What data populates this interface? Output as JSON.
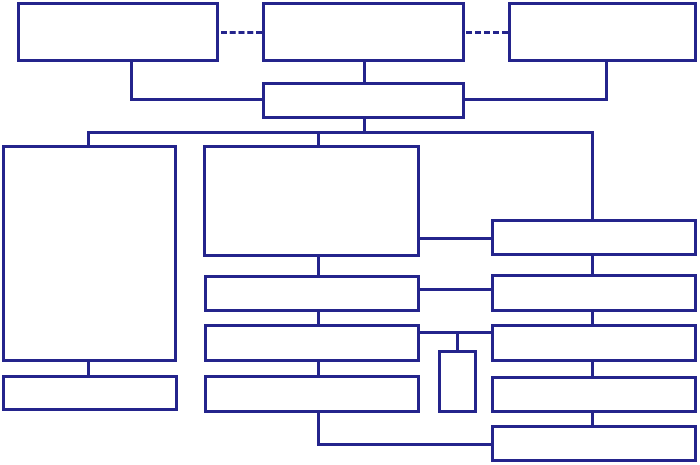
{
  "diagram": {
    "type": "flowchart",
    "background_color": "#ffffff",
    "line_color": "#24248C",
    "box_fill_color": "#ffffff",
    "line_width_px": 3,
    "canvas": {
      "width": 700,
      "height": 465
    },
    "nodes": [
      {
        "id": "top-left-box",
        "label": "",
        "x": 17,
        "y": 2,
        "w": 202,
        "h": 60
      },
      {
        "id": "top-center-box",
        "label": "",
        "x": 262,
        "y": 2,
        "w": 203,
        "h": 60
      },
      {
        "id": "top-right-box",
        "label": "",
        "x": 508,
        "y": 2,
        "w": 189,
        "h": 60
      },
      {
        "id": "hub-box",
        "label": "",
        "x": 262,
        "y": 82,
        "w": 203,
        "h": 37
      },
      {
        "id": "left-tall-box",
        "label": "",
        "x": 2,
        "y": 145,
        "w": 175,
        "h": 217
      },
      {
        "id": "left-bottom-box",
        "label": "",
        "x": 2,
        "y": 375,
        "w": 176,
        "h": 36
      },
      {
        "id": "center-large-box",
        "label": "",
        "x": 203,
        "y": 145,
        "w": 217,
        "h": 112
      },
      {
        "id": "middle-box-2",
        "label": "",
        "x": 204,
        "y": 275,
        "w": 216,
        "h": 37
      },
      {
        "id": "middle-box-3",
        "label": "",
        "x": 204,
        "y": 324,
        "w": 216,
        "h": 38
      },
      {
        "id": "middle-box-4",
        "label": "",
        "x": 204,
        "y": 375,
        "w": 216,
        "h": 38
      },
      {
        "id": "small-vertical-box",
        "label": "",
        "x": 438,
        "y": 350,
        "w": 39,
        "h": 63
      },
      {
        "id": "right-box-1",
        "label": "",
        "x": 491,
        "y": 219,
        "w": 206,
        "h": 37
      },
      {
        "id": "right-box-2",
        "label": "",
        "x": 491,
        "y": 274,
        "w": 206,
        "h": 38
      },
      {
        "id": "right-box-3",
        "label": "",
        "x": 491,
        "y": 324,
        "w": 206,
        "h": 38
      },
      {
        "id": "right-box-4",
        "label": "",
        "x": 491,
        "y": 376,
        "w": 206,
        "h": 37
      },
      {
        "id": "right-box-5",
        "label": "",
        "x": 491,
        "y": 425,
        "w": 206,
        "h": 37
      }
    ],
    "solid_connectors": [
      {
        "id": "topleft-down-connector",
        "orientation": "v",
        "x": 130,
        "y": 60,
        "length": 41
      },
      {
        "id": "topleft-elbow-connector",
        "orientation": "h",
        "x": 130,
        "y": 98,
        "length": 133
      },
      {
        "id": "topcenter-down-connector",
        "orientation": "v",
        "x": 363,
        "y": 60,
        "length": 24
      },
      {
        "id": "topright-down-connector",
        "orientation": "v",
        "x": 605,
        "y": 60,
        "length": 41
      },
      {
        "id": "topright-elbow-connector",
        "orientation": "h",
        "x": 463,
        "y": 98,
        "length": 145
      },
      {
        "id": "hub-down-connector",
        "orientation": "v",
        "x": 363,
        "y": 117,
        "length": 17
      },
      {
        "id": "main-bus-connector",
        "orientation": "h",
        "x": 88,
        "y": 131,
        "length": 506
      },
      {
        "id": "bus-to-lefttall-connector",
        "orientation": "v",
        "x": 87,
        "y": 131,
        "length": 16
      },
      {
        "id": "bus-to-center-connector",
        "orientation": "v",
        "x": 317,
        "y": 131,
        "length": 16
      },
      {
        "id": "bus-to-right1-connector",
        "orientation": "v",
        "x": 591,
        "y": 131,
        "length": 90
      },
      {
        "id": "center-right1-connector",
        "orientation": "h",
        "x": 419,
        "y": 237,
        "length": 73
      },
      {
        "id": "middle2-right2-connector",
        "orientation": "h",
        "x": 419,
        "y": 288,
        "length": 73
      },
      {
        "id": "middle3-right3-connector",
        "orientation": "h",
        "x": 419,
        "y": 331,
        "length": 73
      },
      {
        "id": "smallbox-stub-connector",
        "orientation": "v",
        "x": 456,
        "y": 331,
        "length": 21
      },
      {
        "id": "middle-1-2-connector",
        "orientation": "v",
        "x": 317,
        "y": 255,
        "length": 22
      },
      {
        "id": "middle-2-3-connector",
        "orientation": "v",
        "x": 317,
        "y": 310,
        "length": 16
      },
      {
        "id": "middle-3-4-connector",
        "orientation": "v",
        "x": 317,
        "y": 360,
        "length": 17
      },
      {
        "id": "middle4-down-connector",
        "orientation": "v",
        "x": 317,
        "y": 411,
        "length": 35
      },
      {
        "id": "bottom-elbow-connector",
        "orientation": "h",
        "x": 317,
        "y": 443,
        "length": 175
      },
      {
        "id": "right-1-2-connector",
        "orientation": "v",
        "x": 591,
        "y": 254,
        "length": 22
      },
      {
        "id": "right-2-3-connector",
        "orientation": "v",
        "x": 591,
        "y": 310,
        "length": 16
      },
      {
        "id": "right-3-4-connector",
        "orientation": "v",
        "x": 591,
        "y": 360,
        "length": 18
      },
      {
        "id": "right-4-5-connector",
        "orientation": "v",
        "x": 591,
        "y": 411,
        "length": 16
      },
      {
        "id": "lefttall-down-connector",
        "orientation": "v",
        "x": 87,
        "y": 360,
        "length": 17
      }
    ],
    "dashed_connectors": [
      {
        "id": "dashed-link-left",
        "x": 221,
        "y": 31,
        "length": 41
      },
      {
        "id": "dashed-link-right",
        "x": 466,
        "y": 31,
        "length": 42
      }
    ]
  }
}
